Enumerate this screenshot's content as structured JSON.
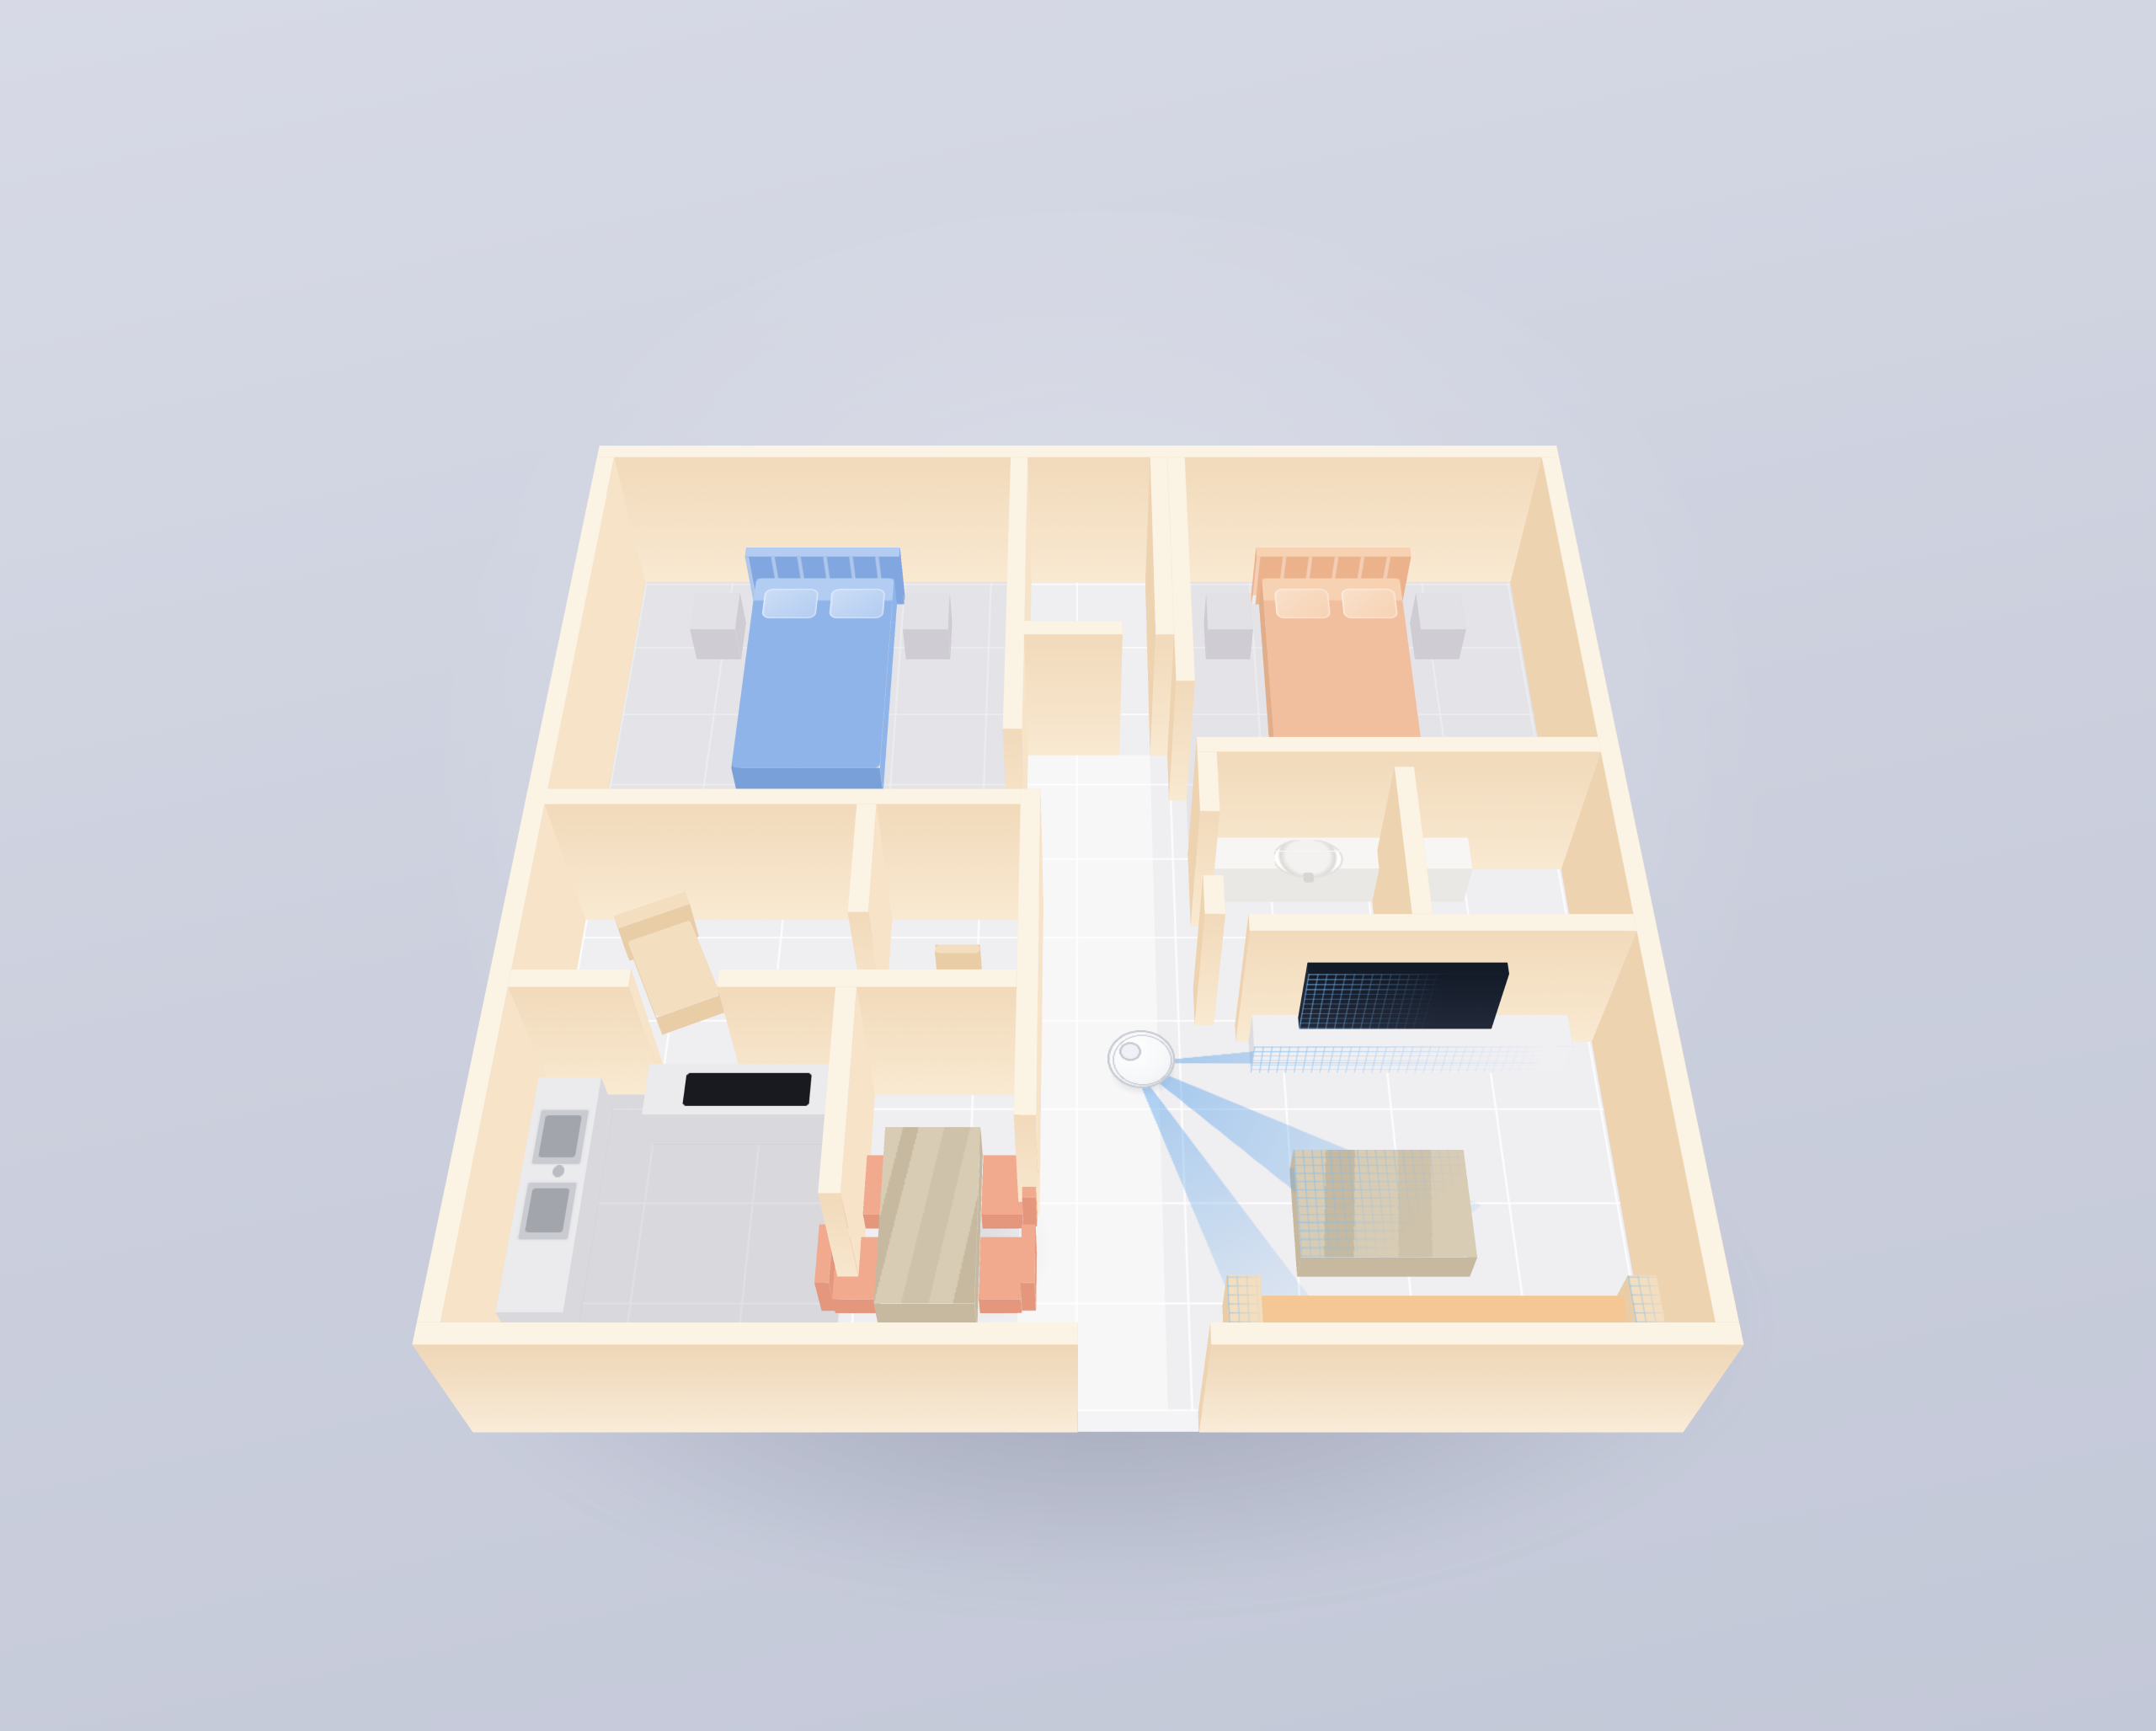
{
  "meta": {
    "title": "3D isometric apartment floor plan with a robot vacuum lidar-scanning the living room",
    "scene": "apartment-3d-render",
    "visible_text": ""
  },
  "colors": {
    "bg1": "#d7dae6",
    "bg2": "#cbcfdd",
    "shadow": "rgba(104,109,133,0.45)",
    "wallTop": "#fbf3e3",
    "wallSouthHi": "#f9ead2",
    "wallSouthLo": "#f2dabb",
    "wallNorthHi": "#f5dcbd",
    "wallNorthLo": "#eccdaa",
    "wallEast": "#f7e3c7",
    "wallWest": "#eed3b1",
    "outerHi": "#f9ecd9",
    "outerLo": "#efd6b7",
    "floor": "#efeef1",
    "floorLine": "rgba(255,255,255,0.85)",
    "hallFloor": "rgba(255,255,255,0.50)",
    "roomTint": "rgba(203,201,209,0.30)",
    "kitchenTint": "rgba(188,188,197,0.45)",
    "aoPatch": "rgba(120,118,132,0.28)",
    "bedBlue": "#8fb4e9",
    "bedBlueLight": "#b3cdf2",
    "headBlue": "#82a7e0",
    "bedOrange": "#f2bf9e",
    "bedOrangeLight": "#f7d2b2",
    "headOrange": "#ecb28c",
    "nightstand": "#e2e1e5",
    "nightstandSide": "#cfcdd3",
    "woodHi": "#d8ccb5",
    "woodLo": "#c6b9a0",
    "chairPink": "#f2aa8e",
    "chairPinkDark": "#e4977c",
    "chairCream": "#f3dfbf",
    "chairCreamSide": "#e8cda6",
    "counter": "#ebebed",
    "counterSide": "#d9d9dd",
    "cooktop": "#191a1f",
    "steel": "#c9cbd0",
    "steelDark": "#a2a5ac",
    "console": "#f0eff2",
    "consoleSide": "#dddce1",
    "tv": "#232b3b",
    "tvDark": "#131a28",
    "sofa": "#f4c795",
    "sofaSide": "#e8b782",
    "sofaArm": "#f3debf",
    "white": "#f7f6f4",
    "whiteSide": "#eae8e4",
    "robotBody": "#f7f8fa",
    "robotEdge": "#c7cad2",
    "robotTurret": "#eef1f5",
    "beamStrong": "rgba(96,166,235,0.55)",
    "beamSoft": "rgba(96,166,235,0.06)",
    "scan": "rgba(125,190,245,0.60)"
  },
  "rooms": [
    {
      "id": "bedroom-blue",
      "label": "Bedroom with blue bed",
      "furniture": [
        "double-bed-blue",
        "pillow-left",
        "pillow-right",
        "nightstand-left",
        "nightstand-right"
      ]
    },
    {
      "id": "closet",
      "label": "Walk-in closet",
      "furniture": []
    },
    {
      "id": "bedroom-orange",
      "label": "Bedroom with orange bed",
      "furniture": [
        "double-bed-orange",
        "pillow-left",
        "pillow-right",
        "nightstand-left",
        "nightstand-right"
      ]
    },
    {
      "id": "study",
      "label": "Study",
      "furniture": [
        "lounge-chair",
        "desk-chair"
      ]
    },
    {
      "id": "bathroom",
      "label": "Bathroom",
      "furniture": [
        "vanity-counter",
        "washbasin",
        "faucet",
        "toilet"
      ]
    },
    {
      "id": "kitchen",
      "label": "Kitchen",
      "furniture": [
        "counter-run",
        "counter-left",
        "cooktop",
        "double-sink"
      ]
    },
    {
      "id": "dining",
      "label": "Dining area",
      "furniture": [
        "dining-table",
        "chair-1",
        "chair-2",
        "chair-3",
        "chair-4"
      ]
    },
    {
      "id": "living-room",
      "label": "Living room",
      "furniture": [
        "tv-console",
        "tv",
        "coffee-table",
        "sofa"
      ]
    },
    {
      "id": "hallway",
      "label": "Hallway / entry",
      "furniture": [
        "robot-vacuum"
      ]
    }
  ],
  "robot": {
    "id": "robot-vacuum",
    "state": "lidar-scanning",
    "beams": 3,
    "scanned_objects": [
      "tv-console",
      "tv",
      "coffee-table",
      "sofa"
    ]
  }
}
